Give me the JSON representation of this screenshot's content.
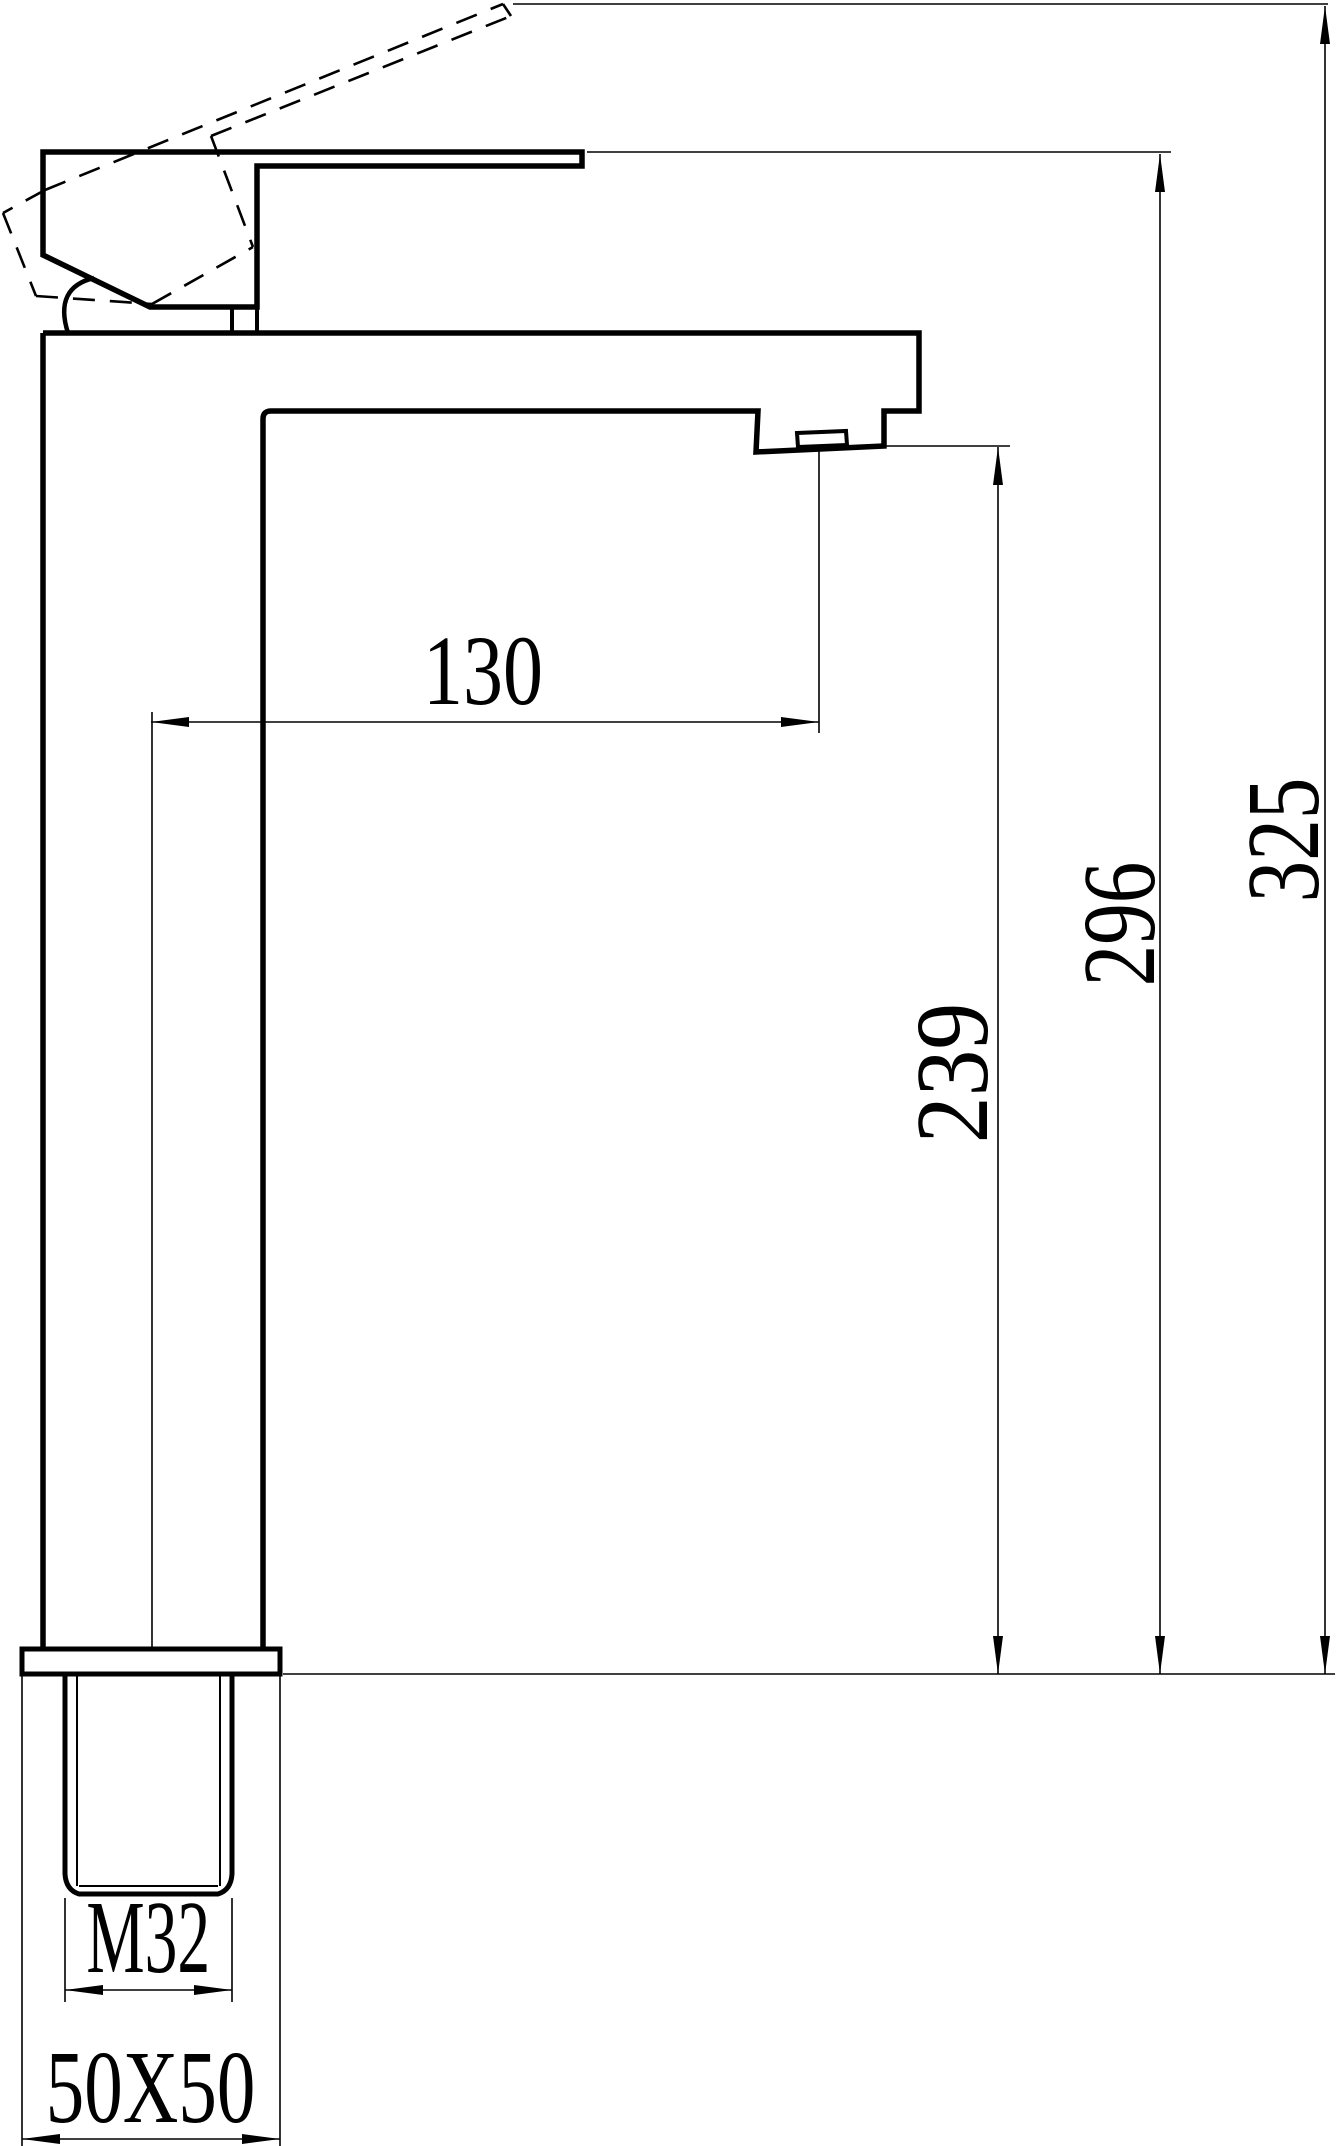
{
  "page": {
    "background_color": "#ffffff",
    "line_color": "#000000"
  },
  "drawing": {
    "title": "tall basin mixer faucet - side elevation technical drawing",
    "labels": {
      "spout_reach": "130",
      "spout_outlet_height": "239",
      "lever_top_height": "296",
      "max_height": "325",
      "shank_thread": "M32",
      "base_plate_size": "50X50"
    }
  }
}
